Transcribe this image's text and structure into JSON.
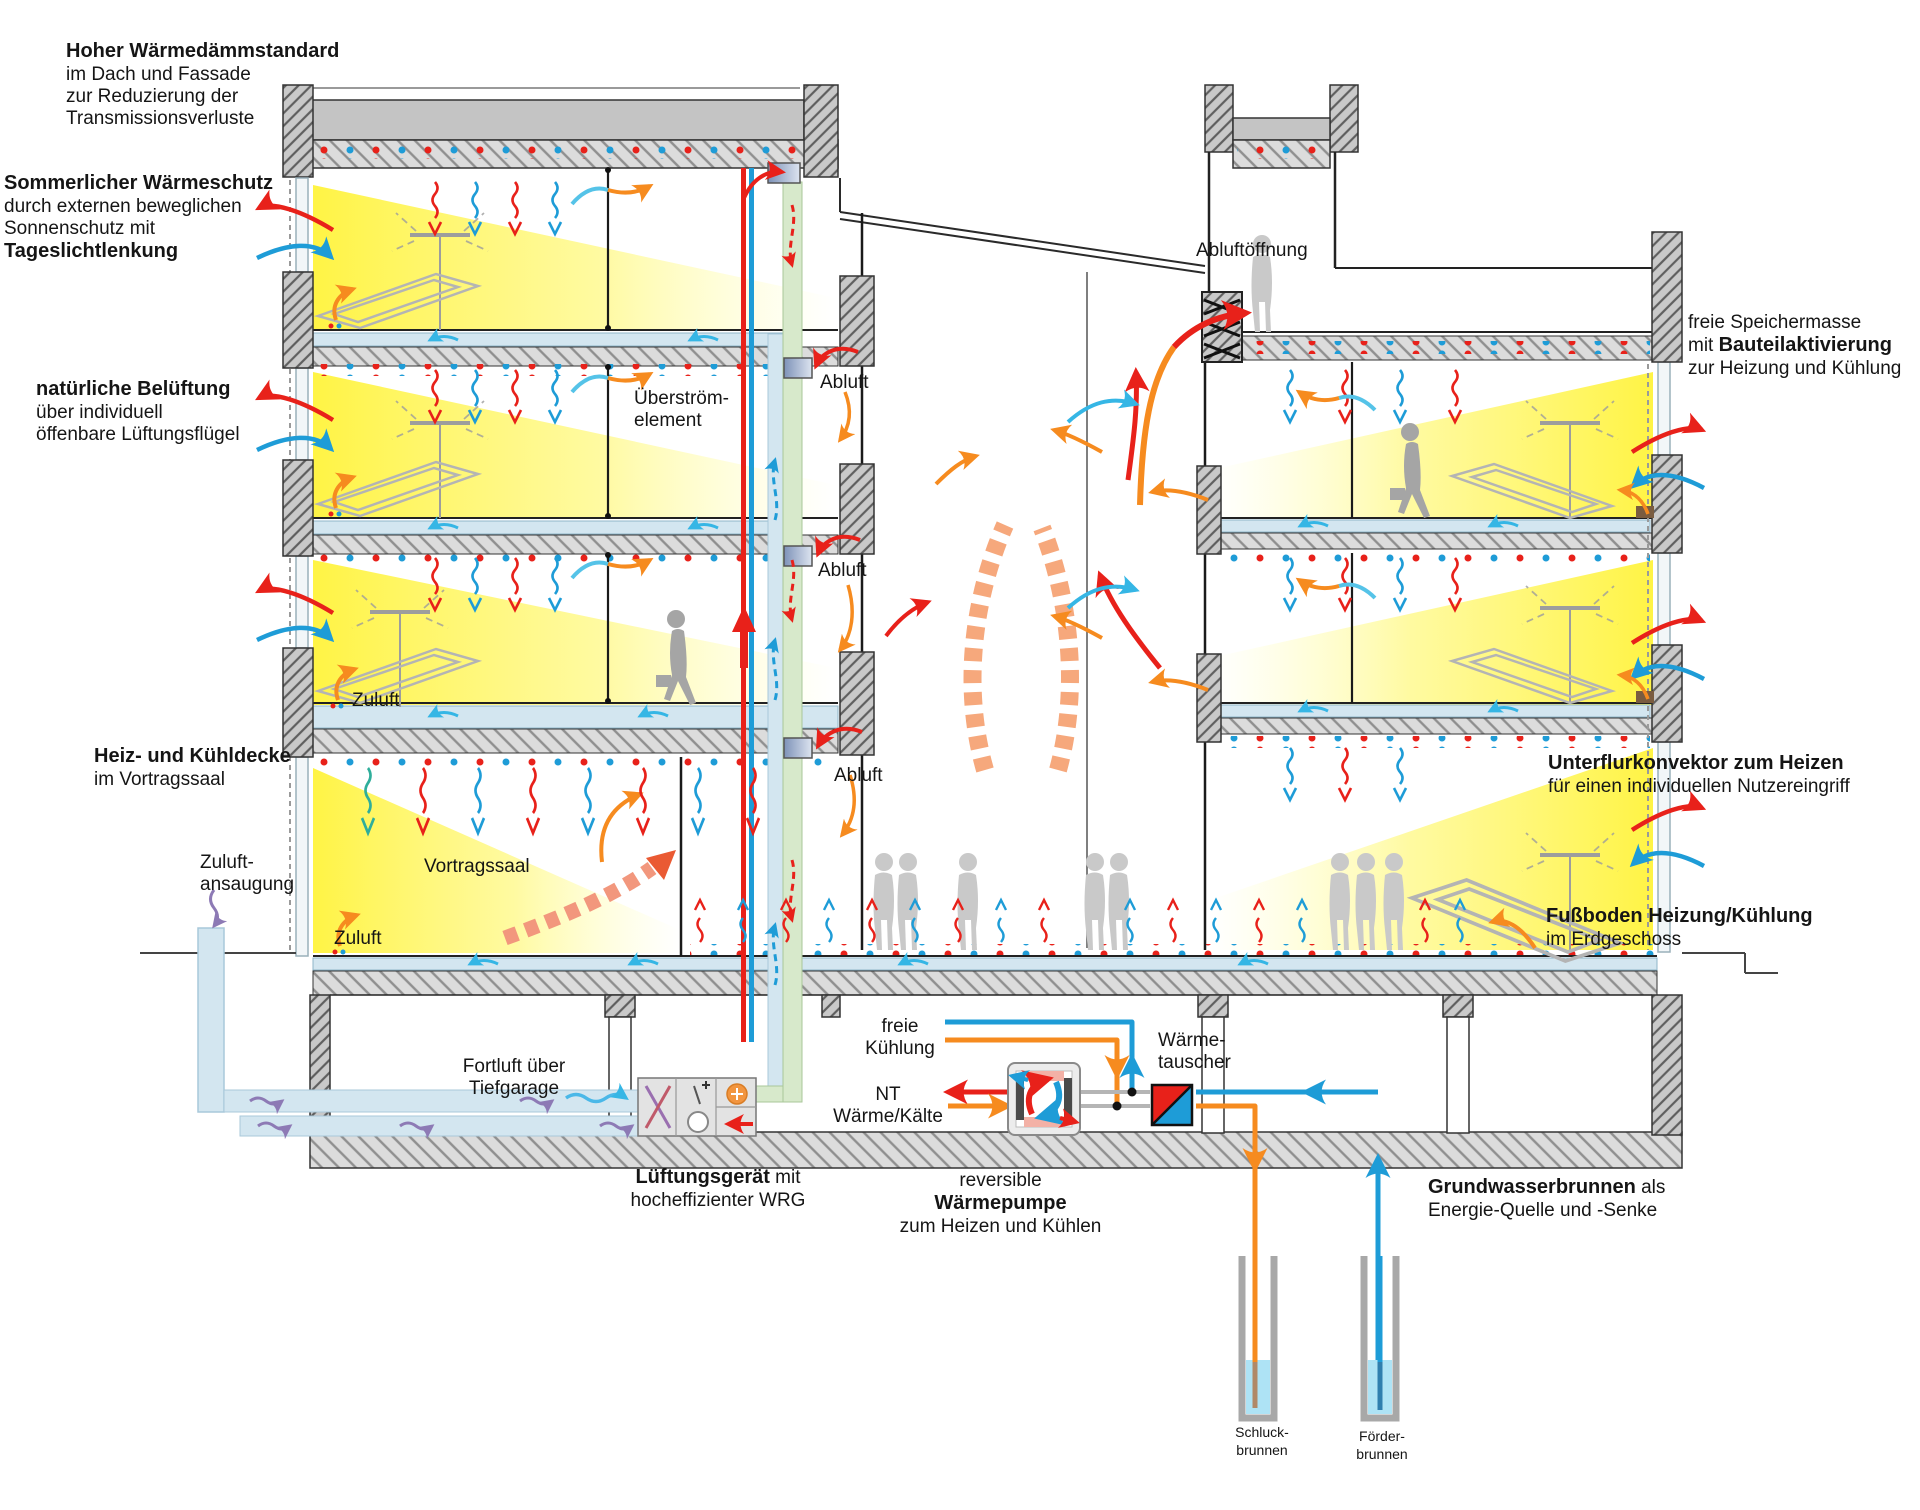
{
  "diagram": {
    "type": "building-section-energy-concept",
    "language": "de"
  },
  "annotations": {
    "insulation_title": "Hoher Wärmedämmstandard",
    "insulation_l1": "im Dach und Fassade",
    "insulation_l2": "zur Reduzierung der",
    "insulation_l3": "Transmissionsverluste",
    "summer_title": "Sommerlicher Wärmeschutz",
    "summer_l1": "durch externen beweglichen",
    "summer_l2": "Sonnenschutz mit",
    "summer_l3": "Tageslichtlenkung",
    "natvent_title": "natürliche Belüftung",
    "natvent_l1": "über individuell",
    "natvent_l2": "öffenbare Lüftungsflügel",
    "ceiling_title": "Heiz- und Kühldecke",
    "ceiling_l1": "im Vortragssaal",
    "overflow_l1": "Überström-",
    "overflow_l2": "element",
    "abluft": "Abluft",
    "zuluft": "Zuluft",
    "intake_l1": "Zuluft-",
    "intake_l2": "ansaugung",
    "hall": "Vortragssaal",
    "fortluft_l1": "Fortluft über",
    "fortluft_l2": "Tiefgarage",
    "ahu_bold": "Lüftungsgerät",
    "ahu_rest": " mit",
    "ahu_l2": "hocheffizienter WRG",
    "freecool_l1": "freie",
    "freecool_l2": "Kühlung",
    "nt_l1": "NT",
    "nt_l2": "Wärme/Kälte",
    "hx_l1": "Wärme-",
    "hx_l2": "tauscher",
    "hp_l1": "reversible",
    "hp_l2": "Wärmepumpe",
    "hp_l3": "zum Heizen und Kühlen",
    "gw_bold": "Grundwasserbrunnen",
    "gw_rest": " als",
    "gw_l2": "Energie-Quelle und -Senke",
    "well1_l1": "Schluck-",
    "well1_l2": "brunnen",
    "well2_l1": "Förder-",
    "well2_l2": "brunnen",
    "exhaust_opening": "Abluftöffnung",
    "mass_l1": "freie Speichermasse",
    "mass_l2_pre": "mit ",
    "mass_l2_bold": "Bauteilaktivierung",
    "mass_l3": "zur Heizung und Kühlung",
    "convector_title": "Unterflurkonvektor zum Heizen",
    "convector_l1": "für einen individuellen Nutzereingriff",
    "floorheat_title": "Fußboden Heizung/Kühlung",
    "floorheat_l1": "im Erdgeschoss"
  },
  "colors": {
    "heat_red": "#e8211a",
    "cool_blue": "#1e9cd7",
    "supply_orange": "#f68b1f",
    "daylight_yellow": "#fff33b",
    "exhaust_shaft_green": "#d7e9cb",
    "supply_duct_blue": "#d3e6f0",
    "structure_gray": "#c9c9c9",
    "silhouette_gray": "#c6c6c6",
    "groundwater_blue": "#aee3f5",
    "garage_air_purple": "#8d7ab5",
    "rising_air_salmon": "#f6a87c"
  }
}
